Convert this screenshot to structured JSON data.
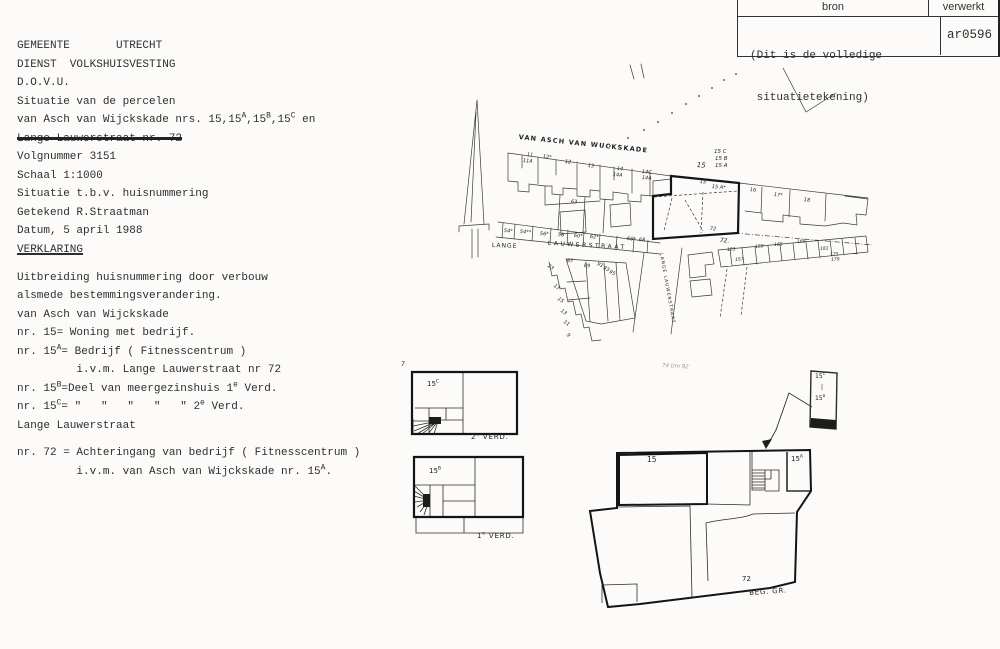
{
  "stamp": {
    "header_left": "bron",
    "header_right": "verwerkt",
    "note_line1": "(Dit is de volledige",
    "note_line2": " situatietekening)",
    "code": "ar0596"
  },
  "document": {
    "lines": [
      {
        "t": "GEMEENTE       UTRECHT"
      },
      {
        "t": "DIENST  VOLKSHUISVESTING"
      },
      {
        "t": "D.O.V.U."
      },
      {
        "t": "Situatie van de percelen"
      },
      {
        "t": "van Asch van Wijckskade nrs. 15,15^A^,15^B^,15^C^ en"
      },
      {
        "t": "Lange Lauwerstraat nr. 72",
        "s": true
      },
      {
        "t": "Volgnummer 3151"
      },
      {
        "t": "Schaal 1:1000"
      },
      {
        "t": "Situatie t.b.v. huisnummering"
      },
      {
        "t": "Getekend R.Straatman"
      },
      {
        "t": "Datum, 5 april 1988"
      },
      {
        "t": "VERKLARING",
        "u": true
      },
      {
        "t": "Uitbreiding huisnummering door verbouw",
        "gap": 9
      },
      {
        "t": "alsmede bestemmingsverandering."
      },
      {
        "t": "van Asch van Wijckskade"
      },
      {
        "t": "nr. 15= Woning met bedrijf."
      },
      {
        "t": "nr. 15^A^= Bedrijf ( Fitnesscentrum )"
      },
      {
        "t": "         i.v.m. Lange Lauwerstraat nr 72"
      },
      {
        "t": "nr. 15^B^=Deel van meergezinshuis 1^e^ Verd."
      },
      {
        "t": "nr. 15^C^= \"   \"   \"   \"   \" 2^e^ Verd."
      },
      {
        "t": "Lange Lauwerstraat"
      },
      {
        "t": "nr. 72 = Achteringang van bedrijf ( Fitnesscentrum )",
        "gap": 9
      },
      {
        "t": "         i.v.m. van Asch van Wijckskade nr. 15^A^."
      }
    ]
  },
  "map": {
    "labels": [
      {
        "t": "VAN ASCH VAN WUCKSKADE",
        "x": 519,
        "y": 134,
        "r": 6,
        "fs": 6.5,
        "ls": 1.2,
        "b": 1,
        "n": "street-label-van-asch-van-wijckskade"
      },
      {
        "t": "LANGE",
        "x": 492,
        "y": 243,
        "r": 2,
        "fs": 6,
        "ls": 1,
        "n": "street-label-lange"
      },
      {
        "t": "LAUWERSTRAAT",
        "x": 548,
        "y": 241,
        "r": 3,
        "fs": 6,
        "ls": 2.5,
        "n": "street-label-lauwerstraat"
      },
      {
        "t": "LANGE LAUWERSTRAAT",
        "x": 662,
        "y": 253,
        "r": 80,
        "fs": 4.5,
        "ls": 1,
        "n": "street-label-lange-lauwerstraat-vertical"
      },
      {
        "t": "11",
        "x": 527,
        "y": 153,
        "r": 5,
        "i": 1
      },
      {
        "t": "11A",
        "x": 523,
        "y": 159,
        "r": 5,
        "i": 1
      },
      {
        "t": "12*",
        "x": 543,
        "y": 155,
        "r": 5,
        "i": 1
      },
      {
        "t": "12",
        "x": 565,
        "y": 160,
        "r": 5,
        "i": 1
      },
      {
        "t": "13",
        "x": 588,
        "y": 164,
        "r": 5,
        "i": 1
      },
      {
        "t": "14",
        "x": 617,
        "y": 167,
        "r": 5,
        "i": 1
      },
      {
        "t": "14A",
        "x": 613,
        "y": 173,
        "r": 5,
        "i": 1
      },
      {
        "t": "14C",
        "x": 642,
        "y": 170,
        "r": 5,
        "i": 1
      },
      {
        "t": "14A",
        "x": 642,
        "y": 176,
        "r": 5,
        "i": 1
      },
      {
        "t": "15",
        "x": 697,
        "y": 162,
        "r": 5,
        "fs": 7,
        "i": 1
      },
      {
        "t": "15",
        "x": 700,
        "y": 180,
        "r": 5,
        "i": 1
      },
      {
        "t": "15 C",
        "x": 714,
        "y": 150,
        "fs": 5.5,
        "i": 1
      },
      {
        "t": "15 B",
        "x": 715,
        "y": 157,
        "fs": 5.5,
        "i": 1
      },
      {
        "t": "15 A",
        "x": 715,
        "y": 164,
        "fs": 5.5,
        "i": 1
      },
      {
        "t": "15 A*",
        "x": 712,
        "y": 185,
        "r": 5,
        "i": 1
      },
      {
        "t": "72",
        "x": 710,
        "y": 227,
        "r": 4,
        "i": 1
      },
      {
        "t": "72.",
        "x": 720,
        "y": 238,
        "r": 4,
        "fs": 6,
        "i": 1
      },
      {
        "t": "16",
        "x": 750,
        "y": 188,
        "r": 6,
        "i": 1
      },
      {
        "t": "17*",
        "x": 774,
        "y": 193,
        "r": 6,
        "i": 1
      },
      {
        "t": "18",
        "x": 804,
        "y": 198,
        "r": 6,
        "i": 1
      },
      {
        "t": "54*",
        "x": 504,
        "y": 229,
        "r": 4,
        "i": 1
      },
      {
        "t": "54**",
        "x": 520,
        "y": 230,
        "r": 4,
        "i": 1
      },
      {
        "t": "56*",
        "x": 540,
        "y": 232,
        "r": 4,
        "i": 1
      },
      {
        "t": "58",
        "x": 558,
        "y": 233,
        "r": 4,
        "i": 1
      },
      {
        "t": "60*",
        "x": 574,
        "y": 234,
        "r": 4,
        "i": 1
      },
      {
        "t": "62*",
        "x": 590,
        "y": 235,
        "r": 4,
        "i": 1
      },
      {
        "t": "66*",
        "x": 627,
        "y": 237,
        "r": 4,
        "i": 1
      },
      {
        "t": "68",
        "x": 639,
        "y": 238,
        "r": 4,
        "i": 1
      },
      {
        "t": "63",
        "x": 571,
        "y": 200,
        "r": 4,
        "i": 1
      },
      {
        "t": "87",
        "x": 567,
        "y": 259,
        "r": 4,
        "i": 1
      },
      {
        "t": "89",
        "x": 584,
        "y": 264,
        "r": 4,
        "i": 1
      },
      {
        "t": "91",
        "x": 598,
        "y": 262,
        "r": 25,
        "i": 1
      },
      {
        "t": "93",
        "x": 604,
        "y": 266,
        "r": 25,
        "i": 1
      },
      {
        "t": "95",
        "x": 610,
        "y": 270,
        "r": 25,
        "i": 1
      },
      {
        "t": "23",
        "x": 549,
        "y": 264,
        "r": 35,
        "i": 1
      },
      {
        "t": "17",
        "x": 555,
        "y": 284,
        "r": 35,
        "i": 1
      },
      {
        "t": "15",
        "x": 559,
        "y": 297,
        "r": 35,
        "i": 1
      },
      {
        "t": "13",
        "x": 562,
        "y": 309,
        "r": 35,
        "i": 1
      },
      {
        "t": "11",
        "x": 565,
        "y": 320,
        "r": 35,
        "i": 1
      },
      {
        "t": "9",
        "x": 568,
        "y": 333,
        "r": 35,
        "i": 1
      },
      {
        "t": "153",
        "x": 727,
        "y": 249,
        "r": -4,
        "fs": 4.5,
        "i": 1
      },
      {
        "t": "157",
        "x": 735,
        "y": 259,
        "r": -4,
        "fs": 4.5,
        "i": 1
      },
      {
        "t": "159",
        "x": 755,
        "y": 246,
        "r": -4,
        "fs": 4.5,
        "i": 1
      },
      {
        "t": "165",
        "x": 774,
        "y": 244,
        "r": -4,
        "fs": 4.5,
        "i": 1
      },
      {
        "t": "169",
        "x": 797,
        "y": 241,
        "r": -4,
        "fs": 4.5,
        "i": 1
      },
      {
        "t": "181",
        "x": 820,
        "y": 248,
        "r": -4,
        "fs": 4.5,
        "i": 1
      },
      {
        "t": "175",
        "x": 830,
        "y": 254,
        "r": -4,
        "fs": 4.5,
        "i": 1
      },
      {
        "t": "179",
        "x": 831,
        "y": 259,
        "r": -4,
        "fs": 4.5,
        "i": 1
      },
      {
        "t": "74 t/m 92",
        "x": 662,
        "y": 364,
        "r": 3,
        "fs": 5.5,
        "i": 1,
        "c": "#9a9a96"
      }
    ]
  },
  "plans": {
    "labels": [
      {
        "t": "15^C^",
        "x": 427,
        "y": 381,
        "fs": 7,
        "n": "plan-label-15c"
      },
      {
        "t": "2^e^ VERD.",
        "x": 471,
        "y": 434,
        "fs": 7,
        "ls": 0.8,
        "n": "floor-label-2e-verd"
      },
      {
        "t": "15^B^",
        "x": 429,
        "y": 468,
        "fs": 7,
        "n": "plan-label-15b"
      },
      {
        "t": "1^e^ VERD.",
        "x": 477,
        "y": 533,
        "fs": 7,
        "ls": 0.8,
        "n": "floor-label-1e-verd"
      },
      {
        "t": "15",
        "x": 647,
        "y": 456,
        "fs": 7.5,
        "n": "plan-label-15"
      },
      {
        "t": "15^A^",
        "x": 791,
        "y": 456,
        "fs": 7,
        "n": "plan-label-15a"
      },
      {
        "t": "72",
        "x": 742,
        "y": 576,
        "fs": 7,
        "n": "plan-label-72"
      },
      {
        "t": "BEG. GR.",
        "x": 749,
        "y": 590,
        "fs": 7,
        "r": -4,
        "ls": 0.8,
        "n": "floor-label-beg-gr"
      },
      {
        "t": "7",
        "x": 401,
        "y": 362,
        "fs": 6,
        "i": 1
      },
      {
        "t": "15^C^",
        "x": 815,
        "y": 374,
        "fs": 6,
        "n": "legend-label-15c"
      },
      {
        "t": "|",
        "x": 821,
        "y": 385,
        "fs": 6
      },
      {
        "t": "15^B^",
        "x": 815,
        "y": 396,
        "fs": 6,
        "n": "legend-label-15b"
      }
    ]
  }
}
